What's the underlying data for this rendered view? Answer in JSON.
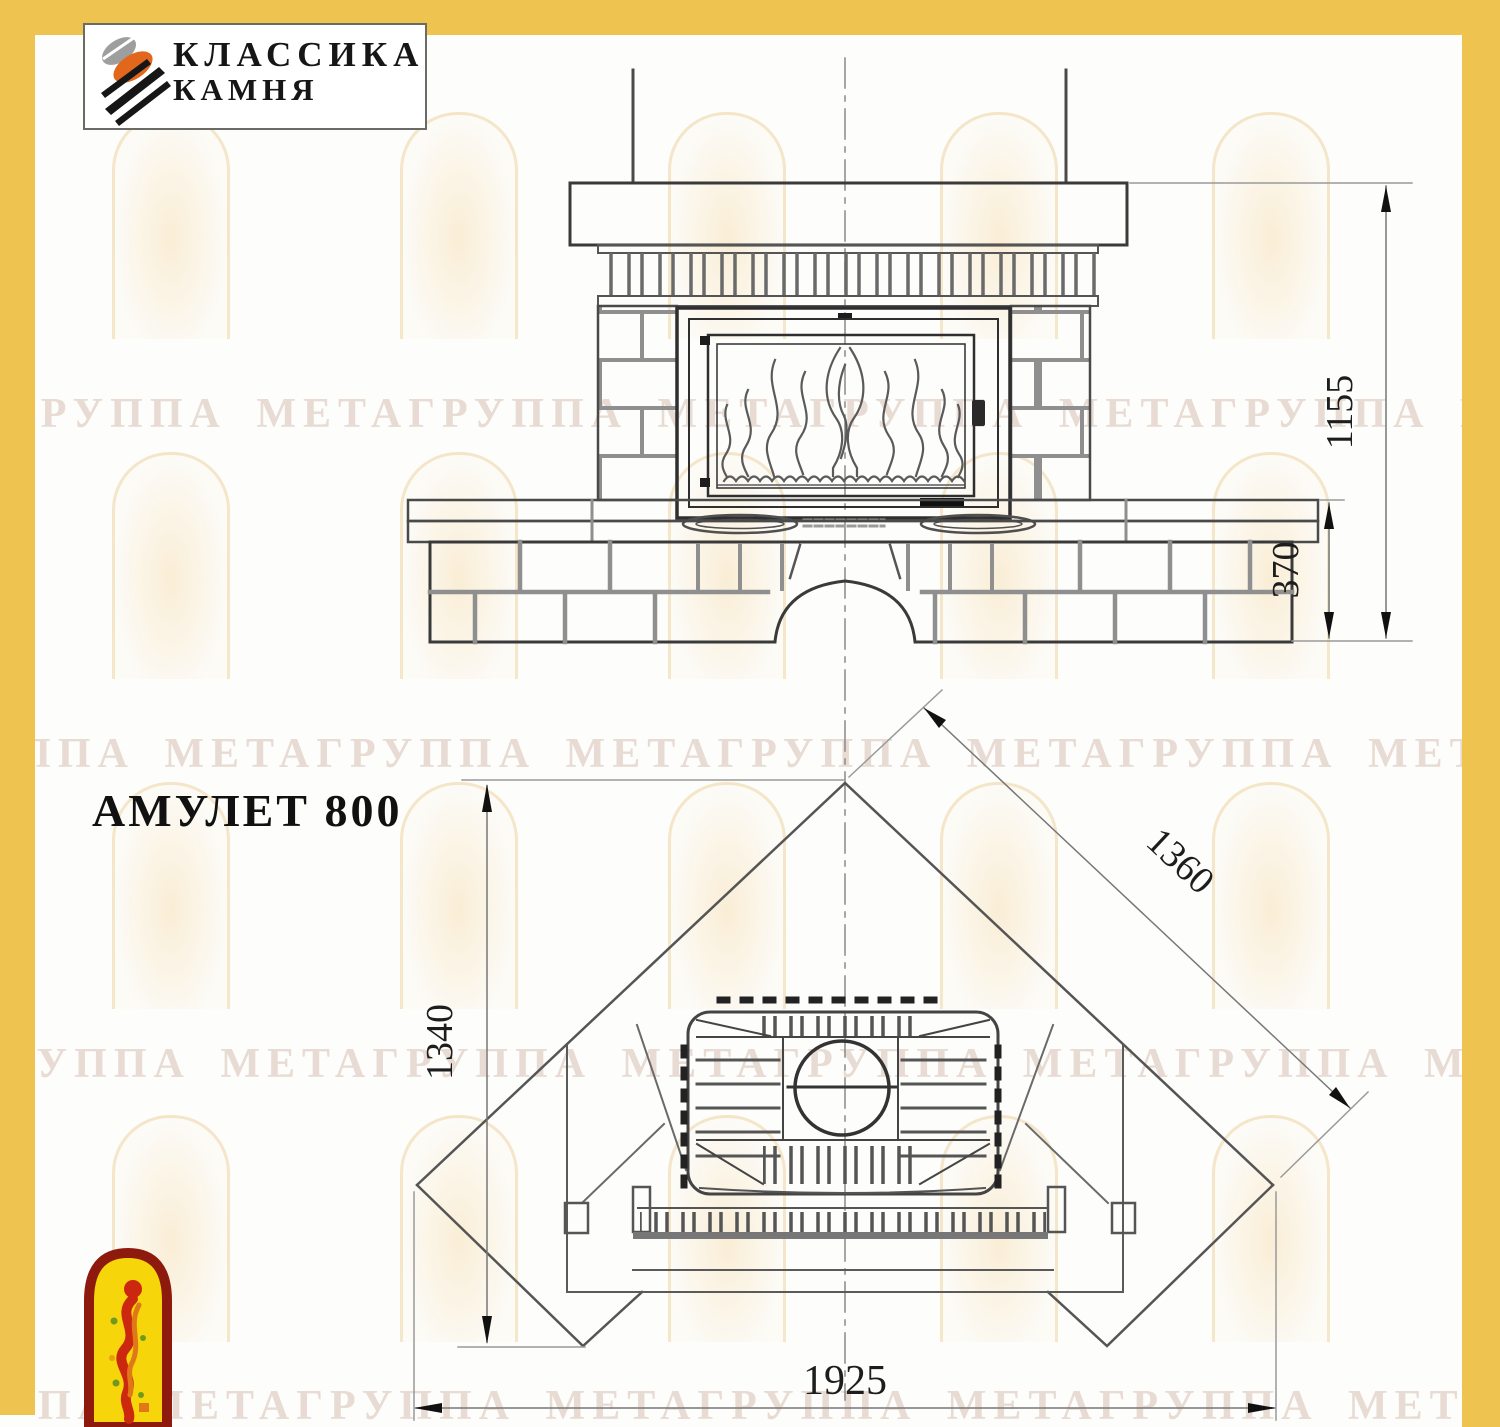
{
  "page": {
    "border_color": "#EFC34F",
    "background": "#FDFDFB"
  },
  "header_logo": {
    "line1": "КЛАССИКА",
    "line2": "КАМНЯ",
    "icon": "stone-logo-icon",
    "icon_colors": {
      "gray": "#9e9e9e",
      "orange": "#e2661c",
      "black": "#161616"
    }
  },
  "watermark": {
    "text": "ГРУППА МЕТАГРУППА МЕТАГРУППА МЕТАГРУППА МЕТА"
  },
  "drawing": {
    "title": "АМУЛЕТ 800",
    "front_view": {
      "total_height": "1155",
      "hearth_height": "370"
    },
    "plan_view": {
      "depth": "1340",
      "wall_side": "1360",
      "front_width": "1925"
    }
  },
  "footer_emblem": {
    "icon": "firebird-emblem",
    "colors": {
      "border": "#8d1a0c",
      "fill": "#F6D60A",
      "figure": "#cc2810",
      "accent": "#e07818",
      "dots": "#6f9a1e"
    }
  }
}
